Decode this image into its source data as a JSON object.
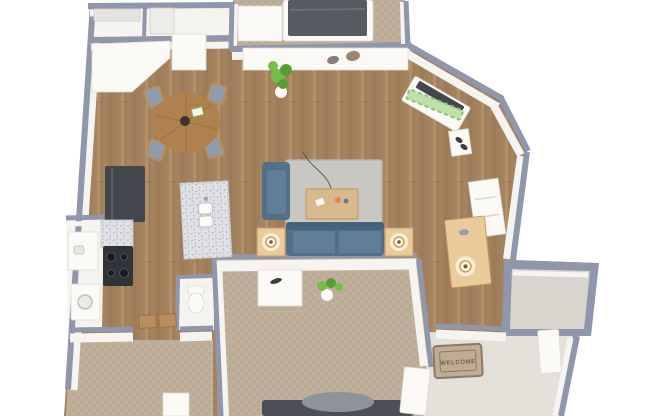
{
  "scene": {
    "title": "3D apartment floor plan render",
    "labels": {
      "welcome_mat": "WELCOME"
    },
    "rooms": [
      {
        "name": "bedroom-top",
        "floor": "carpet",
        "furniture": [
          "bed",
          "dresser"
        ]
      },
      {
        "name": "closets-top-left",
        "floor": "white",
        "furniture": [
          "shelves"
        ]
      },
      {
        "name": "dining-area",
        "floor": "wood",
        "furniture": [
          "round-table",
          "four-chairs"
        ]
      },
      {
        "name": "kitchen-galley",
        "floor": "wood",
        "furniture": [
          "fridge",
          "stove",
          "granite-counters",
          "double-sink",
          "white-cabinets"
        ]
      },
      {
        "name": "living-room",
        "floor": "wood",
        "furniture": [
          "sofa",
          "armchair",
          "area-rug",
          "coffee-table",
          "end-table-lamp-left",
          "end-table-lamp-right",
          "media-console",
          "decor-stones",
          "plant",
          "tv-console",
          "art-board"
        ]
      },
      {
        "name": "bathroom-left",
        "floor": "white",
        "furniture": [
          "vanity",
          "washer"
        ]
      },
      {
        "name": "bathroom-right",
        "floor": "white",
        "furniture": [
          "toilet"
        ]
      },
      {
        "name": "bedroom-master",
        "floor": "carpet",
        "furniture": [
          "bed",
          "nightstand",
          "plant",
          "door"
        ]
      },
      {
        "name": "bedroom-second",
        "floor": "carpet",
        "furniture": [
          "dresser"
        ]
      },
      {
        "name": "entry-hall",
        "floor": "wood",
        "furniture": [
          "console-table-lamp",
          "shoes",
          "wall-shelf"
        ]
      },
      {
        "name": "entry",
        "floor": "tile",
        "furniture": [
          "welcome-mat",
          "door"
        ]
      },
      {
        "name": "balcony",
        "floor": "concrete",
        "furniture": []
      }
    ]
  },
  "colors": {
    "wall": "#9096ab",
    "wallFace": "#f6f4f0",
    "white": "#fbfaf7",
    "doorEdge": "#dedbd4",
    "wood1": "#a5835f",
    "wood2": "#8a684637",
    "wood2s": "#8a6846",
    "wood3": "#bb9a72",
    "carpet1": "#bfae99",
    "carpet2": "#a5947d",
    "rug": "#c8c7c2",
    "rugEdge": "#b5b4af",
    "sofa": "#53708a",
    "sofaLight": "#607e97",
    "sofaDark": "#47627a",
    "tableWood": "#d9b98c",
    "tableEdge": "#c09a67",
    "lightWood": "#e9cb9c",
    "lampGlow": "#f8eed6",
    "lampRing": "#c69c63",
    "lampCore": "#7e5430",
    "dining": "#b0804f",
    "diningDark": "#96683c",
    "cushion": "#8f9cab",
    "chairWood": "#b98e5d",
    "appliance": "#43474d",
    "applianceDark": "#303338",
    "burner": "#17191c",
    "granite": "#e0e1e7",
    "graniteDot": "#a7a9b4",
    "tile": "#e4e1db",
    "concrete": "#d8d5ce",
    "plant": "#76bd4c",
    "plantDark": "#55a033",
    "blanket": "#575c63",
    "pillow": "#8d939b",
    "bedDark": "#4b5056",
    "mat": "#c0ab93",
    "matBorder": "#8d7a65",
    "matText": "#6f5f4e",
    "stoneA": "#8a7f72",
    "stoneB": "#9b8674",
    "shoe": "#3a3d40",
    "artA": "#bfe0a8",
    "artB": "#8fc177"
  }
}
